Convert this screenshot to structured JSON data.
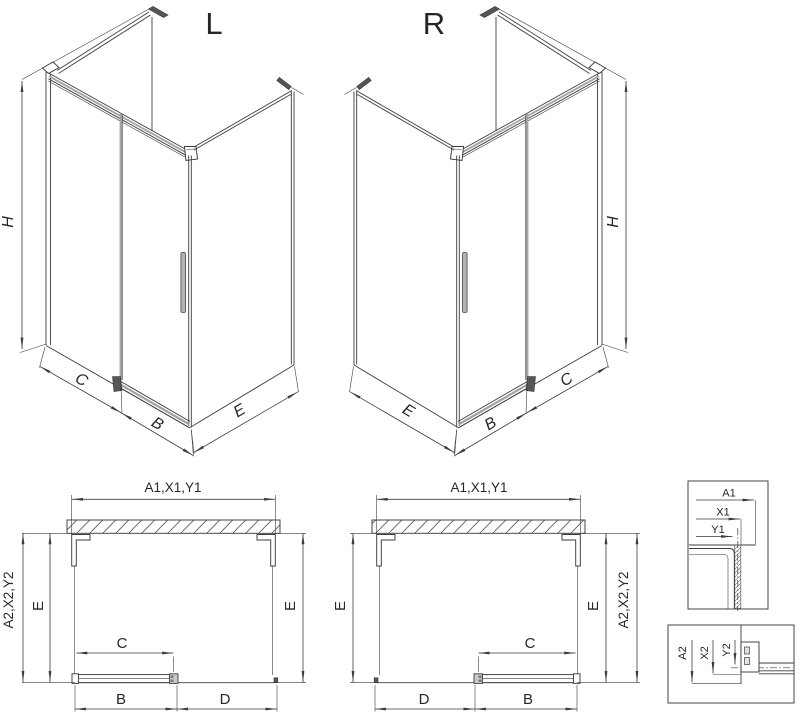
{
  "colors": {
    "line": "#3d3d3d",
    "gray_glass_edge": "#a2a2a2",
    "background": "#ffffff"
  },
  "iso_left": {
    "title": "L",
    "height": "H",
    "fixed_width": "C",
    "door_width": "B",
    "side_width": "E"
  },
  "iso_right": {
    "title": "R",
    "height": "H",
    "fixed_width": "C",
    "door_width": "B",
    "side_width": "E"
  },
  "plan_left": {
    "total_width": "A1,X1,Y1",
    "total_depth": "A2,X2,Y2",
    "side_left": "E",
    "side_right": "E",
    "door_glass": "C",
    "door_rail": "B",
    "fixed_panel": "D"
  },
  "plan_right": {
    "total_width": "A1,X1,Y1",
    "total_depth": "A2,X2,Y2",
    "side_left": "E",
    "side_right": "E",
    "door_glass": "C",
    "door_rail": "B",
    "fixed_panel": "D"
  },
  "detail_wall_profile": {
    "a1": "A1",
    "x1": "X1",
    "y1": "Y1"
  },
  "detail_bottom_rail": {
    "a2": "A2",
    "x2": "X2",
    "y2": "Y2"
  }
}
